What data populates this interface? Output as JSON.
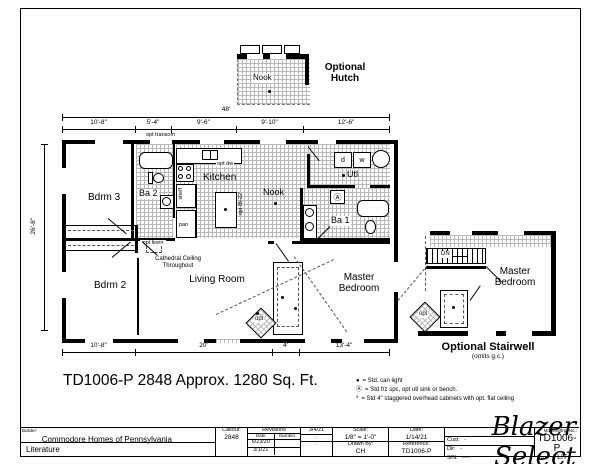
{
  "colors": {
    "ink": "#000000",
    "tile_line": "#b8b8b8"
  },
  "hutch": {
    "caption": "Optional Hutch",
    "nook": "Nook"
  },
  "plan": {
    "rooms": {
      "bdrm3": "Bdrm 3",
      "bdrm2": "Bdrm 2",
      "ba2": "Ba 2",
      "kitchen": "Kitchen",
      "nook": "Nook",
      "utl": "Utl",
      "ba1": "Ba 1",
      "master": "Master Bedroom",
      "living": "Living Room"
    },
    "notes": {
      "cathedral": "Cathedral Ceiling Throughout",
      "opt_transom": "opt transom",
      "opt_dw": "opt dw",
      "shelf": "shelf",
      "pan": "pan",
      "opt_linen": "opt linen",
      "island": "opt IB-22'",
      "opt": "opt",
      "dryer": "d",
      "washer": "w",
      "frz": "Ⓐ"
    }
  },
  "dimensions": {
    "overall_width": "48'",
    "top": [
      "10'-8\"",
      "5'-4\"",
      "9'-6\"",
      "9'-10\"",
      "12'-6\""
    ],
    "left": "26'-8\"",
    "bottom": [
      "10'-8\"",
      "20'",
      "4'",
      "13'-4\""
    ]
  },
  "stairwell": {
    "dn": "DN",
    "master": "Master Bedroom",
    "caption": "Optional Stairwell",
    "subcaption": "(omits g.c.)"
  },
  "summary": {
    "title": "TD1006-P 2848 Approx. 1280 Sq. Ft."
  },
  "legend": {
    "items": [
      {
        "symbol": "●",
        "text": "= Std. can light"
      },
      {
        "symbol": "Ⓐ",
        "text": "= Std frz spc, opt utl sink or bench."
      },
      {
        "symbol": "*",
        "text": "= Std 4\" staggered overhead cabinets with opt. flat ceiling"
      }
    ]
  },
  "brand": "Blazer Select",
  "title_block": {
    "builder_label": "Builder:",
    "builder": "Commodore Homes of Pennsylvania",
    "literature": "Literature",
    "callout_label": "Callout:",
    "callout": "2848",
    "revisions_label": "Revisions",
    "date_col": "Date",
    "number_col": "Number",
    "rev_rows": [
      "6/23/20",
      "3/1/21"
    ],
    "rev_right_rows": [
      "3/4/21",
      ".",
      "."
    ],
    "scale_label": "Scale:",
    "scale": "1/8\" = 1'-0\"",
    "drawn_by_label": "Drawn By:",
    "drawn_by": "CH",
    "date_label": "Date:",
    "date": "1/14/21",
    "reference_label": "Reference:",
    "reference": "TD1006-P",
    "cust_label": "Cust:",
    "cust": "-",
    "dlr_label": "Dlr:",
    "dlr": "-",
    "sn_label": "S/N:",
    "sn": "----",
    "model_label": "Model/Mfrg. No.:",
    "model": "TD1006-P",
    "pg_label": "Pg:",
    "pg": "LIT"
  }
}
